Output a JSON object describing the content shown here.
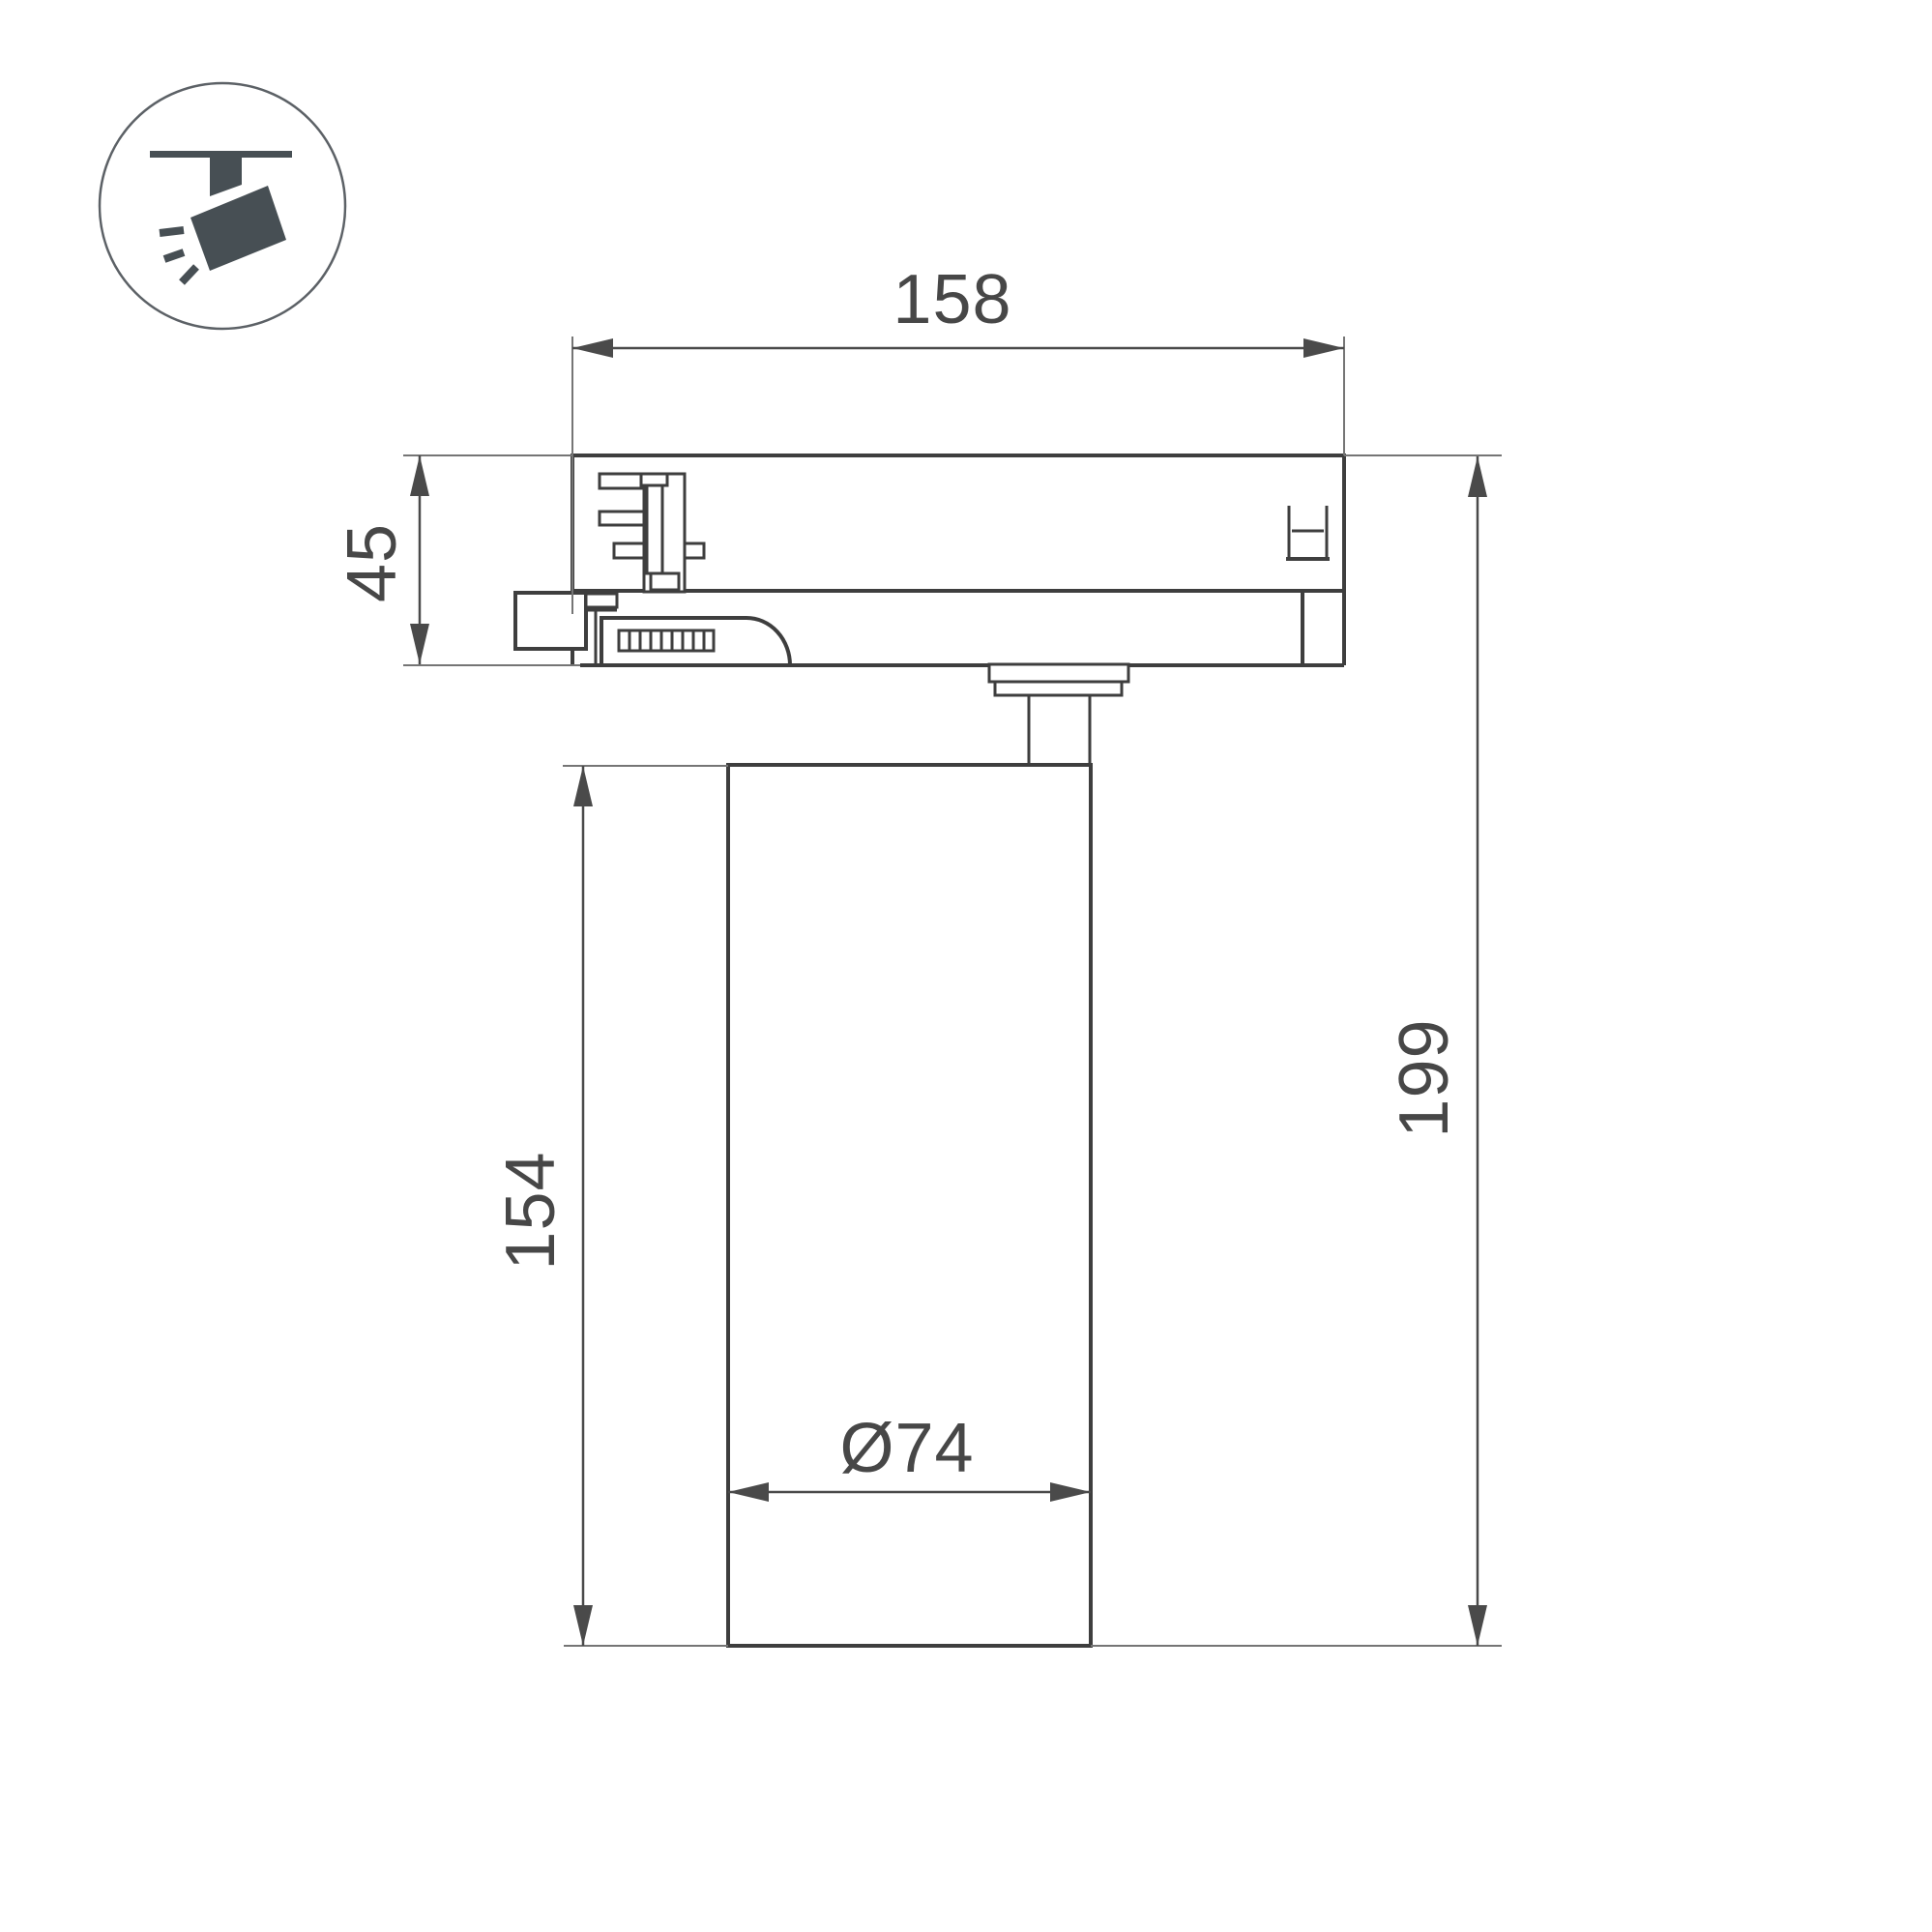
{
  "title": "Track spotlight dimensional drawing",
  "icon": {
    "name": "track-spotlight-icon",
    "description": "ceiling track with tilted spotlight head and light rays"
  },
  "colors": {
    "background": "#ffffff",
    "drawing_line": "#3e3e3e",
    "extension_line": "#757575",
    "dimension_line": "#4a4a4a",
    "text": "#474747",
    "icon": "#474f54"
  },
  "dimensions": {
    "adapter_width": {
      "label": "158"
    },
    "adapter_height": {
      "label": "45"
    },
    "body_height": {
      "label": "154"
    },
    "total_height": {
      "label": "199"
    },
    "body_diameter": {
      "label": "Ø74"
    }
  }
}
